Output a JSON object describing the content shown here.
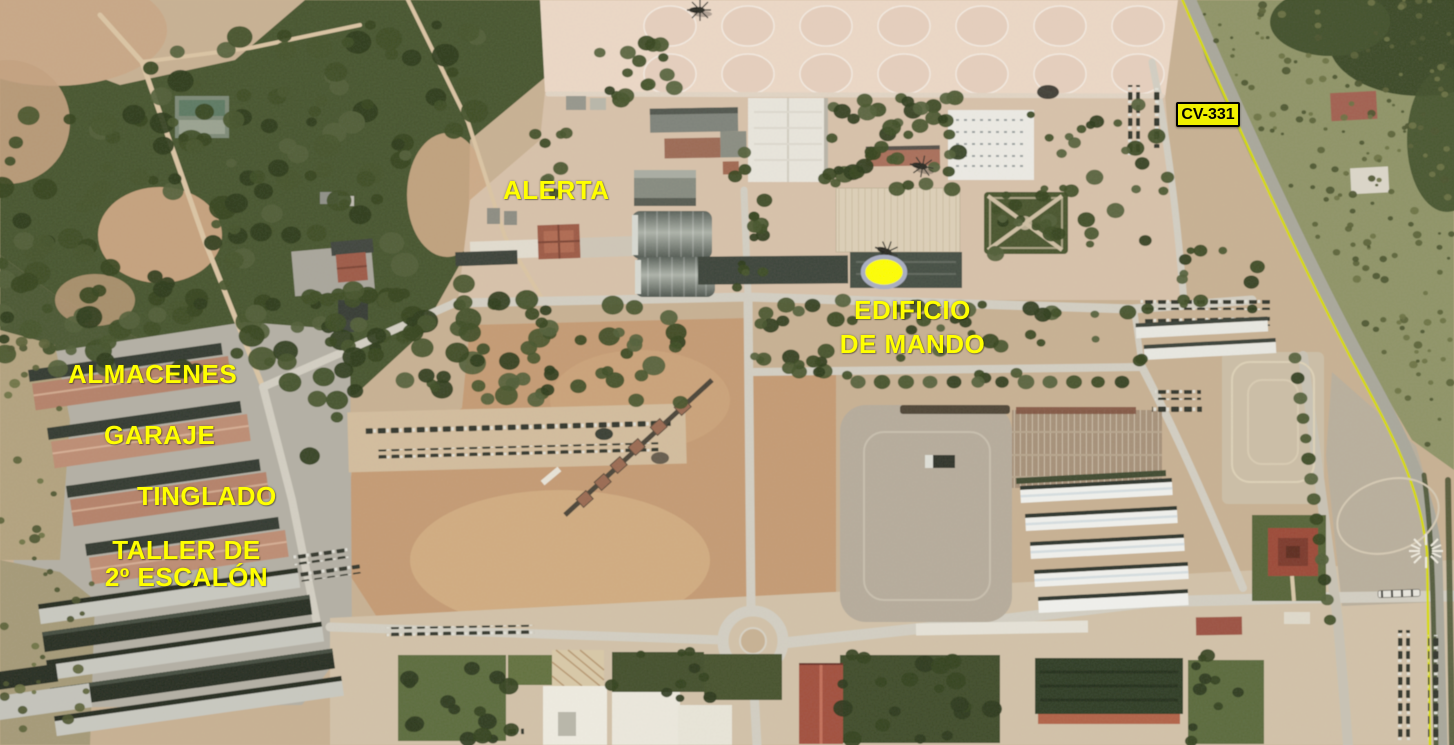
{
  "map": {
    "labels": {
      "alerta": "ALERTA",
      "edificio_line1": "EDIFICIO",
      "edificio_line2": "DE MANDO",
      "almacenes": "ALMACENES",
      "garaje": "GARAJE",
      "tinglado": "TINGLADO",
      "taller_line1": "TALLER DE",
      "taller_line2": "2º ESCALÓN",
      "road_badge": "CV-331"
    },
    "marker": {
      "shape": "ellipse",
      "points_to": "EDIFICIO DE MANDO"
    },
    "colors": {
      "label_yellow": "#ffff00",
      "badge_bg": "#f0f000",
      "badge_border": "#000000",
      "badge_text": "#000000",
      "marker_fill": "#ffff00",
      "marker_stroke": "#a9aec2",
      "road_line_yellow": "#d8dc00"
    }
  }
}
